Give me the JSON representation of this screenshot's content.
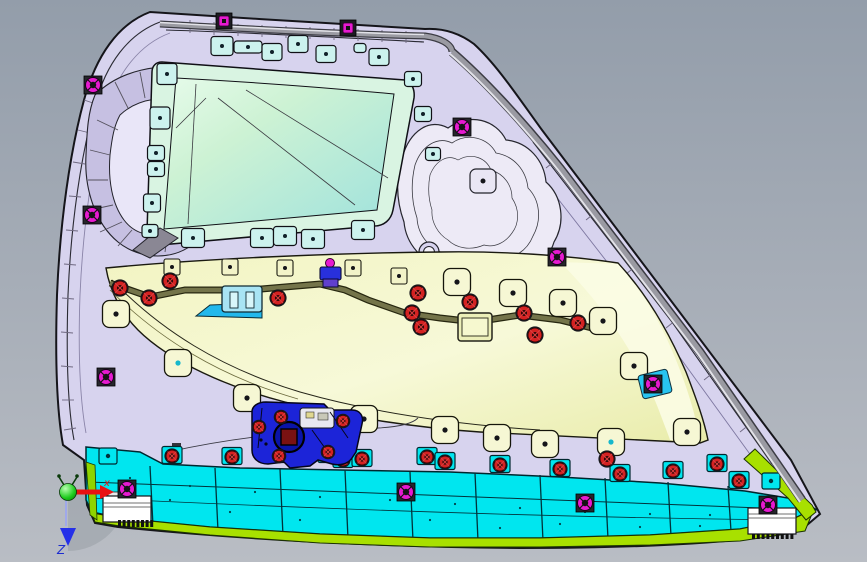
{
  "axis_triad": {
    "x_label": "x",
    "z_label": "Z"
  },
  "colors": {
    "bg1": "#939daa",
    "bg2": "#b9bdc4",
    "shell": "#d7d3ee",
    "shellDark": "#c6c0e2",
    "shellLight": "#e9e6f8",
    "mintFlange": "#d9f4e2",
    "mint1": "#cdf2d4",
    "mint2": "#9fe2dd",
    "clipMint": "#ccf2ee",
    "yellow": "#f2f4c2",
    "yellowLight": "#fbfce4",
    "padYellow": "#f6f7d4",
    "cyan": "#00e6ef",
    "green": "#a8e000",
    "green2": "#8fd400",
    "blue": "#1c24d8",
    "blueDark": "#0a14a8",
    "magenta": "#e61ad0",
    "red": "#d42222",
    "olive": "#74744a",
    "tube": "#9a9aa2",
    "tubeHi": "#e2e2e8",
    "tubeDk": "#3c3c44",
    "axisRed": "#e81212",
    "axisBlue": "#2530e8",
    "axisGreen": "#1ecc1e",
    "white": "#ffffff"
  },
  "features": {
    "mint_clips": [
      [
        222,
        46,
        22,
        19
      ],
      [
        248,
        47,
        28,
        12
      ],
      [
        272,
        52,
        20,
        17
      ],
      [
        298,
        44,
        20,
        17
      ],
      [
        326,
        54,
        20,
        17
      ],
      [
        360,
        48,
        12,
        9
      ],
      [
        379,
        57,
        20,
        17
      ],
      [
        167,
        74,
        20,
        21
      ],
      [
        160,
        118,
        20,
        22
      ],
      [
        156,
        153,
        17,
        15
      ],
      [
        156,
        169,
        17,
        15
      ],
      [
        152,
        203,
        17,
        18
      ],
      [
        150,
        231,
        16,
        13
      ],
      [
        413,
        79,
        17,
        15
      ],
      [
        423,
        114,
        17,
        15
      ],
      [
        433,
        154,
        15,
        13
      ],
      [
        193,
        238,
        23,
        19
      ],
      [
        262,
        238,
        23,
        19
      ],
      [
        285,
        236,
        23,
        19
      ],
      [
        313,
        239,
        23,
        19
      ],
      [
        363,
        230,
        23,
        19
      ]
    ],
    "island_tabs": [
      [
        483,
        181
      ]
    ],
    "pads": [
      [
        116,
        314,
        "k"
      ],
      [
        178,
        363,
        "c"
      ],
      [
        247,
        398,
        "k"
      ],
      [
        364,
        419,
        "k"
      ],
      [
        445,
        430,
        "k"
      ],
      [
        497,
        438,
        "k"
      ],
      [
        545,
        444,
        "k"
      ],
      [
        611,
        442,
        "c"
      ],
      [
        634,
        366,
        "k"
      ],
      [
        687,
        432,
        "k"
      ],
      [
        603,
        321,
        "k"
      ],
      [
        563,
        303,
        "k"
      ],
      [
        513,
        293,
        "k"
      ],
      [
        457,
        282,
        "k"
      ]
    ],
    "small_squares": [
      [
        172,
        267
      ],
      [
        230,
        267
      ],
      [
        285,
        268
      ],
      [
        353,
        268
      ],
      [
        399,
        276
      ]
    ],
    "red_grommets": [
      [
        120,
        288
      ],
      [
        149,
        298
      ],
      [
        170,
        281
      ],
      [
        278,
        298
      ],
      [
        418,
        293
      ],
      [
        412,
        313
      ],
      [
        421,
        327
      ],
      [
        470,
        302
      ],
      [
        524,
        313
      ],
      [
        535,
        335
      ],
      [
        578,
        323
      ],
      [
        607,
        459
      ]
    ],
    "latch_screws": [
      [
        259,
        427
      ],
      [
        281,
        417
      ],
      [
        343,
        421
      ],
      [
        328,
        452
      ],
      [
        279,
        456
      ]
    ],
    "strip_red_tabs": [
      [
        172,
        455
      ],
      [
        232,
        456
      ],
      [
        277,
        454
      ],
      [
        297,
        455
      ],
      [
        328,
        454
      ],
      [
        343,
        459
      ],
      [
        362,
        458
      ],
      [
        427,
        456
      ],
      [
        445,
        461
      ],
      [
        500,
        464
      ],
      [
        560,
        468
      ],
      [
        620,
        473
      ],
      [
        673,
        470
      ],
      [
        717,
        463
      ],
      [
        739,
        480
      ]
    ],
    "cyan_dot_tabs": [
      [
        108,
        456
      ],
      [
        771,
        481
      ]
    ],
    "magenta_round": [
      [
        93,
        85
      ],
      [
        92,
        215
      ],
      [
        106,
        377
      ],
      [
        462,
        127
      ],
      [
        557,
        257
      ],
      [
        653,
        384
      ]
    ],
    "magenta_strip": [
      [
        127,
        489
      ],
      [
        406,
        492
      ],
      [
        585,
        503
      ],
      [
        768,
        505
      ]
    ],
    "magenta_squares": [
      [
        224,
        21
      ],
      [
        348,
        28
      ]
    ],
    "strip_lines": [
      [
        150,
        466,
        526
      ],
      [
        215,
        468,
        531
      ],
      [
        280,
        469,
        536
      ],
      [
        345,
        470,
        539
      ],
      [
        410,
        472,
        541
      ],
      [
        475,
        473,
        541
      ],
      [
        540,
        475,
        541
      ],
      [
        605,
        478,
        539
      ],
      [
        668,
        482,
        536
      ],
      [
        728,
        486,
        531
      ]
    ],
    "strip_dots": [
      [
        130,
        478
      ],
      [
        190,
        486
      ],
      [
        255,
        492
      ],
      [
        320,
        497
      ],
      [
        390,
        500
      ],
      [
        455,
        504
      ],
      [
        520,
        508
      ],
      [
        585,
        512
      ],
      [
        650,
        514
      ],
      [
        710,
        515
      ],
      [
        300,
        520
      ],
      [
        500,
        528
      ],
      [
        640,
        527
      ],
      [
        230,
        512
      ],
      [
        170,
        500
      ],
      [
        430,
        520
      ],
      [
        560,
        524
      ],
      [
        700,
        526
      ],
      [
        760,
        512
      ]
    ],
    "edge_ticks": [
      [
        84,
        100,
        96,
        104
      ],
      [
        78,
        130,
        90,
        133
      ],
      [
        73,
        162,
        85,
        164
      ],
      [
        69,
        196,
        81,
        197
      ],
      [
        66,
        230,
        78,
        231
      ],
      [
        64,
        264,
        76,
        265
      ],
      [
        62,
        298,
        74,
        299
      ],
      [
        61,
        332,
        73,
        333
      ],
      [
        61,
        366,
        73,
        367
      ],
      [
        62,
        400,
        74,
        400
      ],
      [
        64,
        430,
        76,
        428
      ],
      [
        190,
        20,
        190,
        33
      ],
      [
        214,
        22,
        214,
        35
      ],
      [
        238,
        24,
        238,
        36
      ],
      [
        262,
        25,
        262,
        37
      ],
      [
        286,
        26,
        286,
        38
      ],
      [
        310,
        27,
        310,
        39
      ],
      [
        334,
        28,
        334,
        40
      ],
      [
        358,
        29,
        358,
        41
      ],
      [
        382,
        30,
        382,
        42
      ],
      [
        406,
        31,
        406,
        43
      ],
      [
        556,
        160,
        546,
        168
      ],
      [
        596,
        212,
        586,
        220
      ],
      [
        636,
        266,
        626,
        274
      ],
      [
        676,
        320,
        666,
        328
      ],
      [
        714,
        372,
        704,
        380
      ],
      [
        750,
        424,
        740,
        432
      ],
      [
        780,
        466,
        770,
        473
      ]
    ],
    "pocket_ribs": [
      [
        97,
        120,
        118,
        130
      ],
      [
        90,
        150,
        110,
        155
      ],
      [
        88,
        180,
        108,
        180
      ],
      [
        90,
        210,
        113,
        205
      ],
      [
        100,
        232,
        122,
        222
      ],
      [
        118,
        246,
        132,
        230
      ],
      [
        140,
        254,
        148,
        234
      ],
      [
        165,
        252,
        168,
        232
      ],
      [
        188,
        243,
        185,
        225
      ],
      [
        205,
        228,
        196,
        212
      ],
      [
        220,
        205,
        205,
        196
      ],
      [
        228,
        180,
        206,
        176
      ],
      [
        233,
        155,
        208,
        158
      ],
      [
        232,
        130,
        205,
        138
      ],
      [
        222,
        105,
        196,
        118
      ],
      [
        200,
        80,
        180,
        100
      ],
      [
        170,
        68,
        165,
        92
      ],
      [
        140,
        72,
        145,
        98
      ],
      [
        115,
        82,
        128,
        108
      ]
    ],
    "mint_creases": [
      [
        218,
        98,
        355,
        205
      ],
      [
        246,
        90,
        388,
        178
      ],
      [
        196,
        84,
        188,
        224
      ],
      [
        176,
        128,
        206,
        98
      ]
    ],
    "grills": [
      {
        "x": 118,
        "y": 520,
        "n": 8,
        "step": 4.6,
        "w": 3,
        "h": 7
      },
      {
        "x": 752,
        "y": 534,
        "n": 9,
        "step": 4.8,
        "w": 3,
        "h": 5
      }
    ]
  }
}
